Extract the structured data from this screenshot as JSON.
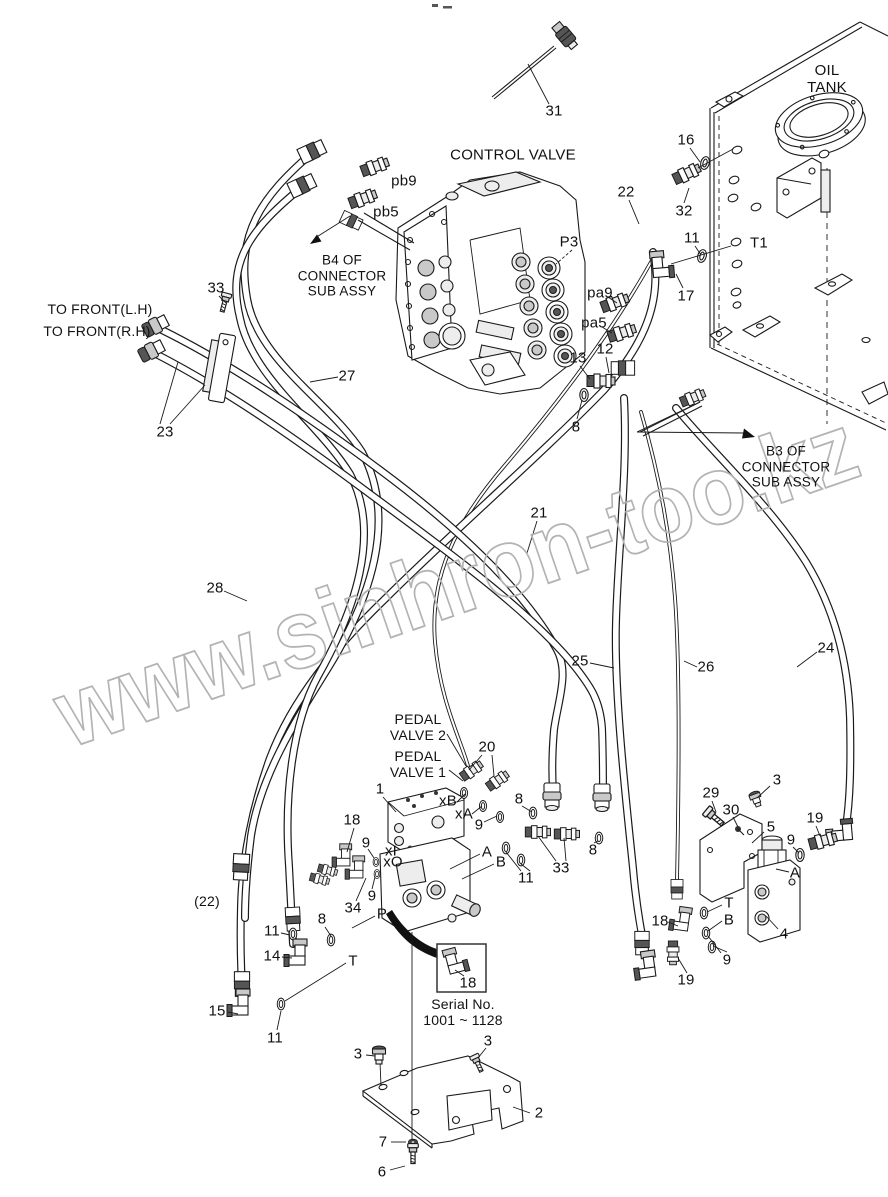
{
  "watermark": {
    "text": "www.sinhron-too.kz",
    "color": "#b3b3b3"
  },
  "colors": {
    "background": "#ffffff",
    "line": "#1a1a1a",
    "text": "#111111"
  },
  "labels": [
    {
      "id": "31",
      "text": "31",
      "x": 554,
      "y": 111
    },
    {
      "id": "oil-tank",
      "text": "OIL TANK",
      "x": 827,
      "y": 79
    },
    {
      "id": "control-valve",
      "text": "CONTROL VALVE",
      "x": 513,
      "y": 155
    },
    {
      "id": "pb9",
      "text": "pb9",
      "x": 404,
      "y": 181
    },
    {
      "id": "pb5",
      "text": "pb5",
      "x": 386,
      "y": 212
    },
    {
      "id": "b4-note",
      "text": "B4 OF\nCONNECTOR\nSUB ASSY",
      "x": 342,
      "y": 276,
      "fs": 13.5
    },
    {
      "id": "16",
      "text": "16",
      "x": 686,
      "y": 140
    },
    {
      "id": "22",
      "text": "22",
      "x": 626,
      "y": 192
    },
    {
      "id": "32",
      "text": "32",
      "x": 684,
      "y": 211
    },
    {
      "id": "11a",
      "text": "11",
      "x": 692,
      "y": 238
    },
    {
      "id": "t1",
      "text": "T1",
      "x": 759,
      "y": 243
    },
    {
      "id": "17",
      "text": "17",
      "x": 686,
      "y": 296
    },
    {
      "id": "p3",
      "text": "P3",
      "x": 569,
      "y": 242
    },
    {
      "id": "pa9",
      "text": "pa9",
      "x": 600,
      "y": 293
    },
    {
      "id": "pa5",
      "text": "pa5",
      "x": 594,
      "y": 323
    },
    {
      "id": "13",
      "text": "13",
      "x": 578,
      "y": 358
    },
    {
      "id": "12",
      "text": "12",
      "x": 605,
      "y": 349
    },
    {
      "id": "8a",
      "text": "8",
      "x": 576,
      "y": 427
    },
    {
      "id": "33a",
      "text": "33",
      "x": 216,
      "y": 288
    },
    {
      "id": "to-front-lh",
      "text": "TO FRONT(L.H)",
      "x": 100,
      "y": 309,
      "fs": 14
    },
    {
      "id": "to-front-rh",
      "text": "TO FRONT(R.H)",
      "x": 97,
      "y": 331,
      "fs": 14
    },
    {
      "id": "23",
      "text": "23",
      "x": 165,
      "y": 432
    },
    {
      "id": "27",
      "text": "27",
      "x": 347,
      "y": 376
    },
    {
      "id": "b3-note",
      "text": "B3 OF CONNECTOR\nSUB ASSY",
      "x": 786,
      "y": 467,
      "fs": 13.5
    },
    {
      "id": "28",
      "text": "28",
      "x": 215,
      "y": 588
    },
    {
      "id": "21",
      "text": "21",
      "x": 539,
      "y": 513
    },
    {
      "id": "25",
      "text": "25",
      "x": 580,
      "y": 661
    },
    {
      "id": "26",
      "text": "26",
      "x": 706,
      "y": 667
    },
    {
      "id": "24",
      "text": "24",
      "x": 826,
      "y": 648
    },
    {
      "id": "pedal-valve-2",
      "text": "PEDAL\nVALVE 2",
      "x": 418,
      "y": 727,
      "fs": 14
    },
    {
      "id": "pedal-valve-1",
      "text": "PEDAL\nVALVE 1",
      "x": 418,
      "y": 764,
      "fs": 14
    },
    {
      "id": "20",
      "text": "20",
      "x": 487,
      "y": 747
    },
    {
      "id": "1",
      "text": "1",
      "x": 380,
      "y": 789
    },
    {
      "id": "xb",
      "text": "xB",
      "x": 448,
      "y": 801
    },
    {
      "id": "xa",
      "text": "xA",
      "x": 464,
      "y": 814
    },
    {
      "id": "9a",
      "text": "9",
      "x": 479,
      "y": 825
    },
    {
      "id": "8b",
      "text": "8",
      "x": 519,
      "y": 799
    },
    {
      "id": "18a",
      "text": "18",
      "x": 352,
      "y": 820
    },
    {
      "id": "9b",
      "text": "9",
      "x": 366,
      "y": 843
    },
    {
      "id": "xi",
      "text": "xI",
      "x": 391,
      "y": 851
    },
    {
      "id": "xo",
      "text": "xO",
      "x": 393,
      "y": 862
    },
    {
      "id": "a1",
      "text": "A",
      "x": 487,
      "y": 852
    },
    {
      "id": "b1",
      "text": "B",
      "x": 501,
      "y": 862
    },
    {
      "id": "11b",
      "text": "11",
      "x": 526,
      "y": 878
    },
    {
      "id": "33b",
      "text": "33",
      "x": 561,
      "y": 868
    },
    {
      "id": "8c",
      "text": "8",
      "x": 593,
      "y": 850
    },
    {
      "id": "34",
      "text": "34",
      "x": 353,
      "y": 908
    },
    {
      "id": "9c",
      "text": "9",
      "x": 372,
      "y": 896
    },
    {
      "id": "p",
      "text": "P",
      "x": 382,
      "y": 914
    },
    {
      "id": "22b",
      "text": "(22)",
      "x": 207,
      "y": 901,
      "fs": 14
    },
    {
      "id": "11c",
      "text": "11",
      "x": 272,
      "y": 931
    },
    {
      "id": "14",
      "text": "14",
      "x": 272,
      "y": 956
    },
    {
      "id": "8d",
      "text": "8",
      "x": 322,
      "y": 919
    },
    {
      "id": "ta",
      "text": "T",
      "x": 353,
      "y": 961
    },
    {
      "id": "15",
      "text": "15",
      "x": 217,
      "y": 1011
    },
    {
      "id": "11d",
      "text": "11",
      "x": 275,
      "y": 1038
    },
    {
      "id": "29",
      "text": "29",
      "x": 711,
      "y": 793
    },
    {
      "id": "30",
      "text": "30",
      "x": 731,
      "y": 810
    },
    {
      "id": "3a",
      "text": "3",
      "x": 777,
      "y": 780
    },
    {
      "id": "5",
      "text": "5",
      "x": 771,
      "y": 827
    },
    {
      "id": "19a",
      "text": "19",
      "x": 815,
      "y": 818
    },
    {
      "id": "9d",
      "text": "9",
      "x": 791,
      "y": 840
    },
    {
      "id": "a2",
      "text": "A",
      "x": 795,
      "y": 873
    },
    {
      "id": "18b",
      "text": "18",
      "x": 660,
      "y": 921
    },
    {
      "id": "tb",
      "text": "T",
      "x": 729,
      "y": 903
    },
    {
      "id": "bb",
      "text": "B",
      "x": 729,
      "y": 920
    },
    {
      "id": "4",
      "text": "4",
      "x": 784,
      "y": 934
    },
    {
      "id": "9e",
      "text": "9",
      "x": 727,
      "y": 960
    },
    {
      "id": "19b",
      "text": "19",
      "x": 686,
      "y": 980
    },
    {
      "id": "18c",
      "text": "18",
      "x": 468,
      "y": 983
    },
    {
      "id": "serial",
      "text": "Serial No.\n1001 ~ 1128",
      "x": 463,
      "y": 1012,
      "fs": 14
    },
    {
      "id": "3b",
      "text": "3",
      "x": 358,
      "y": 1054
    },
    {
      "id": "3c",
      "text": "3",
      "x": 488,
      "y": 1041
    },
    {
      "id": "2",
      "text": "2",
      "x": 539,
      "y": 1113
    },
    {
      "id": "7",
      "text": "7",
      "x": 383,
      "y": 1142
    },
    {
      "id": "6",
      "text": "6",
      "x": 382,
      "y": 1172
    }
  ]
}
